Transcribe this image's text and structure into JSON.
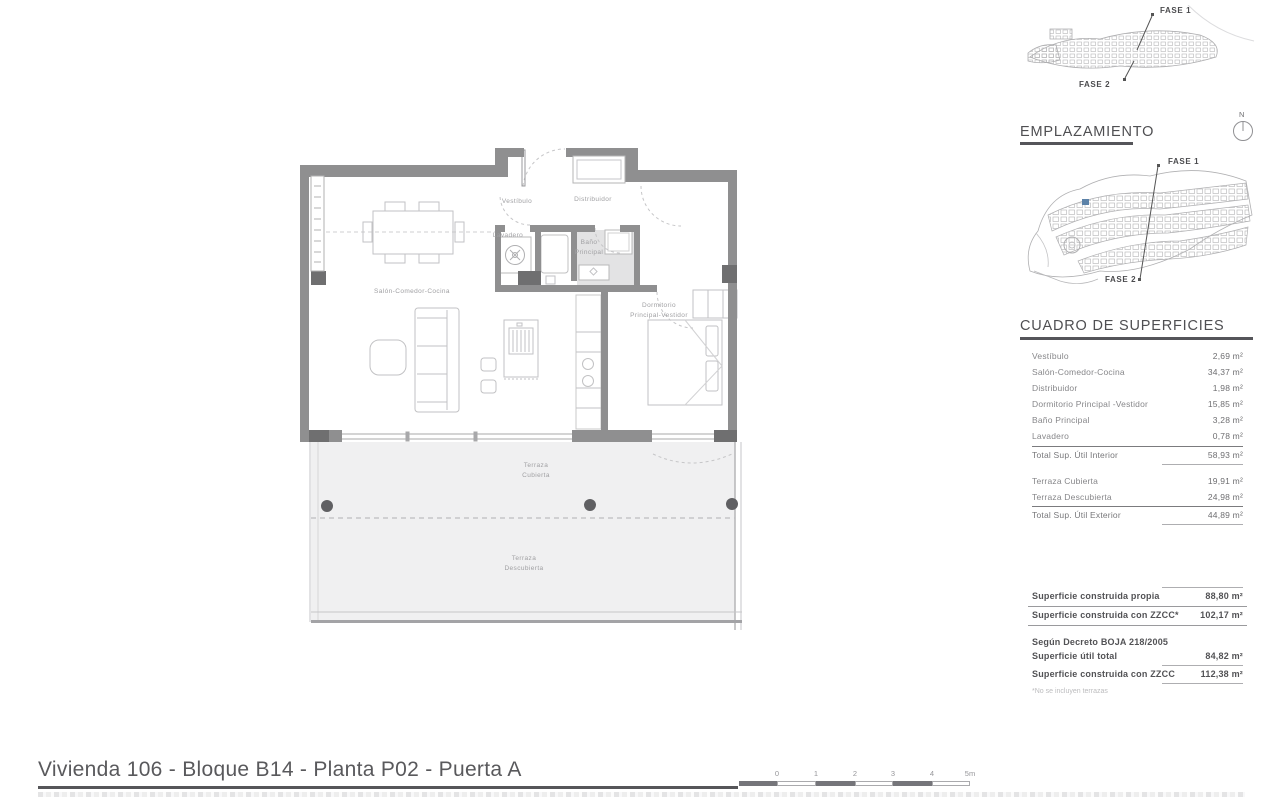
{
  "title": "Vivienda 106 - Bloque B14 - Planta P02 - Puerta A",
  "plan_labels": {
    "vestibulo": "Vestíbulo",
    "distribuidor": "Distribuidor",
    "lavadero": "Lavadero",
    "bano": "Baño\nPrincipal",
    "salon": "Salón-Comedor-Cocina",
    "dormitorio": "Dormitorio\nPrincipal-Vestidor",
    "terraza_cubierta": "Terraza\nCubierta",
    "terraza_descubierta": "Terraza\nDescubierta"
  },
  "site_sketch": {
    "fase1": "FASE 1",
    "fase2": "FASE 2"
  },
  "emplazamiento": {
    "heading": "EMPLAZAMIENTO",
    "north": "N",
    "fase1": "FASE 1",
    "fase2": "FASE 2"
  },
  "cuadro": {
    "heading": "CUADRO DE SUPERFICIES",
    "interior": [
      {
        "label": "Vestíbulo",
        "value": "2,69 m²"
      },
      {
        "label": "Salón-Comedor-Cocina",
        "value": "34,37 m²"
      },
      {
        "label": "Distribuidor",
        "value": "1,98 m²"
      },
      {
        "label": "Dormitorio Principal -Vestidor",
        "value": "15,85 m²"
      },
      {
        "label": "Baño Principal",
        "value": "3,28 m²"
      },
      {
        "label": "Lavadero",
        "value": "0,78 m²"
      }
    ],
    "interior_total": {
      "label": "Total Sup. Útil Interior",
      "value": "58,93 m²"
    },
    "exterior": [
      {
        "label": "Terraza Cubierta",
        "value": "19,91 m²"
      },
      {
        "label": "Terraza Descubierta",
        "value": "24,98 m²"
      }
    ],
    "exterior_total": {
      "label": "Total Sup. Útil Exterior",
      "value": "44,89 m²"
    }
  },
  "summary": {
    "construida": [
      {
        "label": "Superficie construida propia",
        "value": "88,80 m²"
      },
      {
        "label": "Superficie construida con ZZCC*",
        "value": "102,17 m²"
      }
    ],
    "decreto_heading": "Según Decreto BOJA 218/2005",
    "decreto": [
      {
        "label": "Superficie útil total",
        "value": "84,82 m²"
      },
      {
        "label": "Superficie construida con ZZCC",
        "value": "112,38 m²"
      }
    ],
    "footnote": "*No se incluyen terrazas"
  },
  "scalebar": {
    "ticks": [
      "0",
      "1",
      "2",
      "3",
      "4",
      "5m"
    ]
  },
  "colors": {
    "accent_blue": "#5c82a8",
    "wall_gray": "#8f8f90",
    "dark_gray": "#6f6f70"
  }
}
